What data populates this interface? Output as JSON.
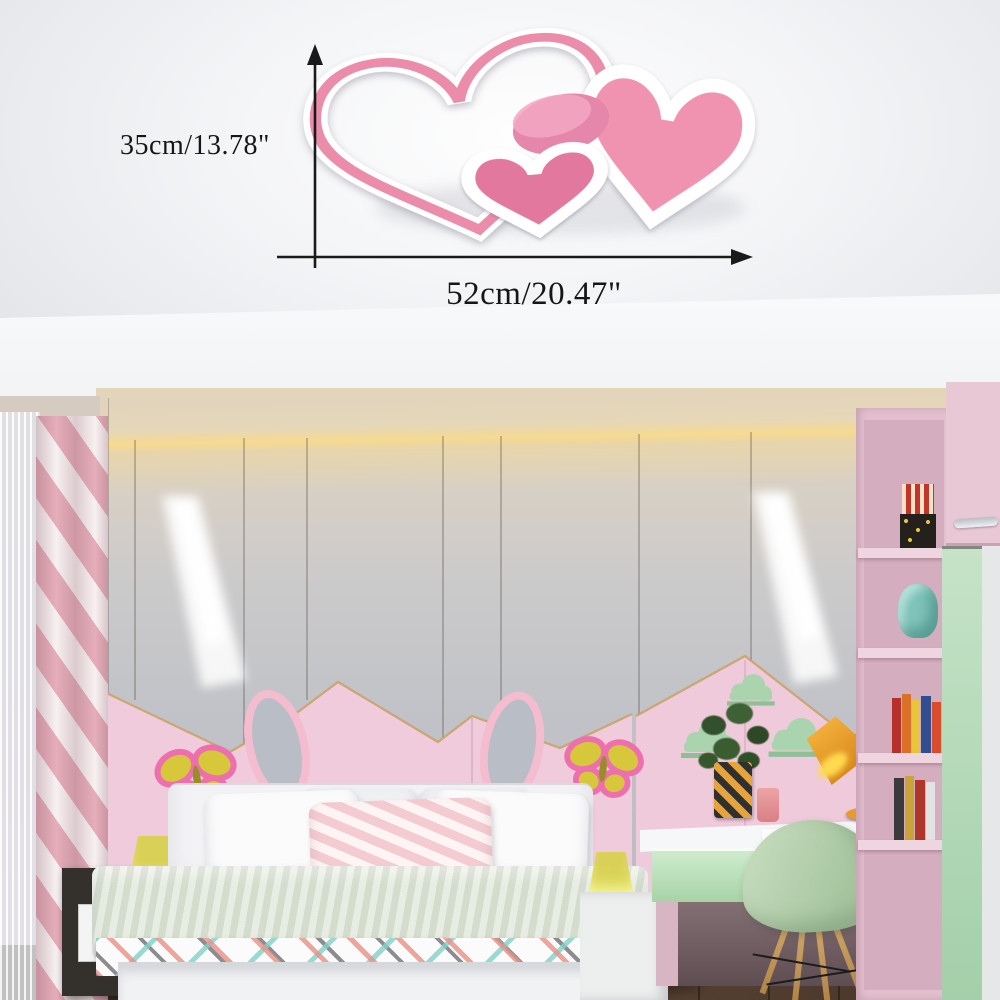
{
  "title": "Heart-shaped LED ceiling lamp in a pink kids bedroom (product dimension photo)",
  "dimension_diagram": {
    "height_label": "35cm/13.78\"",
    "width_label": "52cm/20.47\"",
    "height_arrow": "vertical-double-ended-up-arrow",
    "width_arrow": "horizontal-right-arrow"
  },
  "palette": {
    "lamp_pink_band": "#ec8cab",
    "lamp_heart_fill": "#ef93b1",
    "lamp_small_heart": "#e2789e",
    "lamp_white": "#ffffff",
    "ceiling": "#f2f3f5",
    "cove_glow": "#f6da90",
    "wall_gray_panel": "#c0c2c7",
    "wall_pink_panel": "#f0cbdb",
    "gold_seam": "#c8a36a",
    "mint_cloud": "#a9d4ae",
    "butterfly_yellow": "#d7c73b",
    "butterfly_border": "#ee6fae",
    "curtain_pink": "#e6aebb",
    "chair_green": "#b7d3ab",
    "desk_lamp_orange": "#e89b28",
    "bedside_lamp_yellow": "#d7d04c",
    "nightstand_dark": "#34302c",
    "floor_wood": "#4a3629",
    "bookshelf_pink": "#e4c0cf",
    "wardrobe_door_green": "#b5d9b8"
  },
  "scene": {
    "objects": [
      "heart ceiling lamp (large heart outline, medium heart, small heart, round disc)",
      "dimension arrows with measurements",
      "cove-lit tray ceiling",
      "paneled feature wall with two wall-washer spotlights",
      "pink mountain/house shaped lower wall with gold seams",
      "bunny-ear headboard panels",
      "two yellow butterfly wall decorations",
      "three mint cloud shelves",
      "bed with pillows and colorful blanket",
      "dark nightstand with yellow lamp",
      "white nightstand with yellow lamp",
      "desk with mint drawer, plant, vase, cup, orange task lamp",
      "mint shell chair with wooden legs",
      "pink bookshelf with box, cloud cushion and books",
      "wardrobe with green sliding door",
      "pink chevron curtain and sheer curtain",
      "dark wood floor"
    ]
  }
}
